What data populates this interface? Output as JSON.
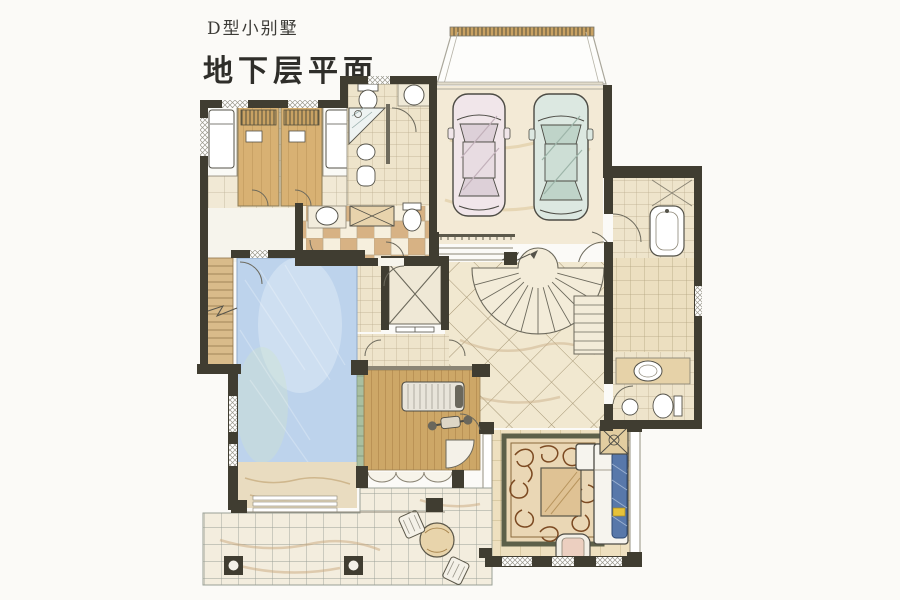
{
  "header": {
    "series_label": "D型小别墅",
    "plan_label": "地下层平面"
  },
  "palette": {
    "wall": "#403d31",
    "paper": "#fbfaf7",
    "pool_water": "#bdd3ec",
    "deck_wood": "#cda767",
    "sauna_wood": "#d8b173",
    "tile_light": "#f1e9d5",
    "checker_tile": "#d7b284",
    "hall_tile": "#f1e8d0",
    "rug": "#ead7b5",
    "rug_swirl": "#7c4a22",
    "sofa_cushion": "#5878aa",
    "car_left": "#f1e6ea",
    "car_right": "#dce8e1",
    "pool_gutter_green": "#a9bfa0"
  },
  "rooms_depicted": [
    "massage-room-left",
    "sauna-room-1",
    "sauna-room-2",
    "spa-bathroom",
    "checker-bathroom",
    "garage",
    "driveway-ramp",
    "indoor-pool",
    "pool-stair",
    "elevator",
    "central-hall",
    "fan-staircase",
    "gym-deck",
    "right-corridor",
    "bathtub-room",
    "guest-bathroom",
    "family-room",
    "outdoor-patio"
  ]
}
